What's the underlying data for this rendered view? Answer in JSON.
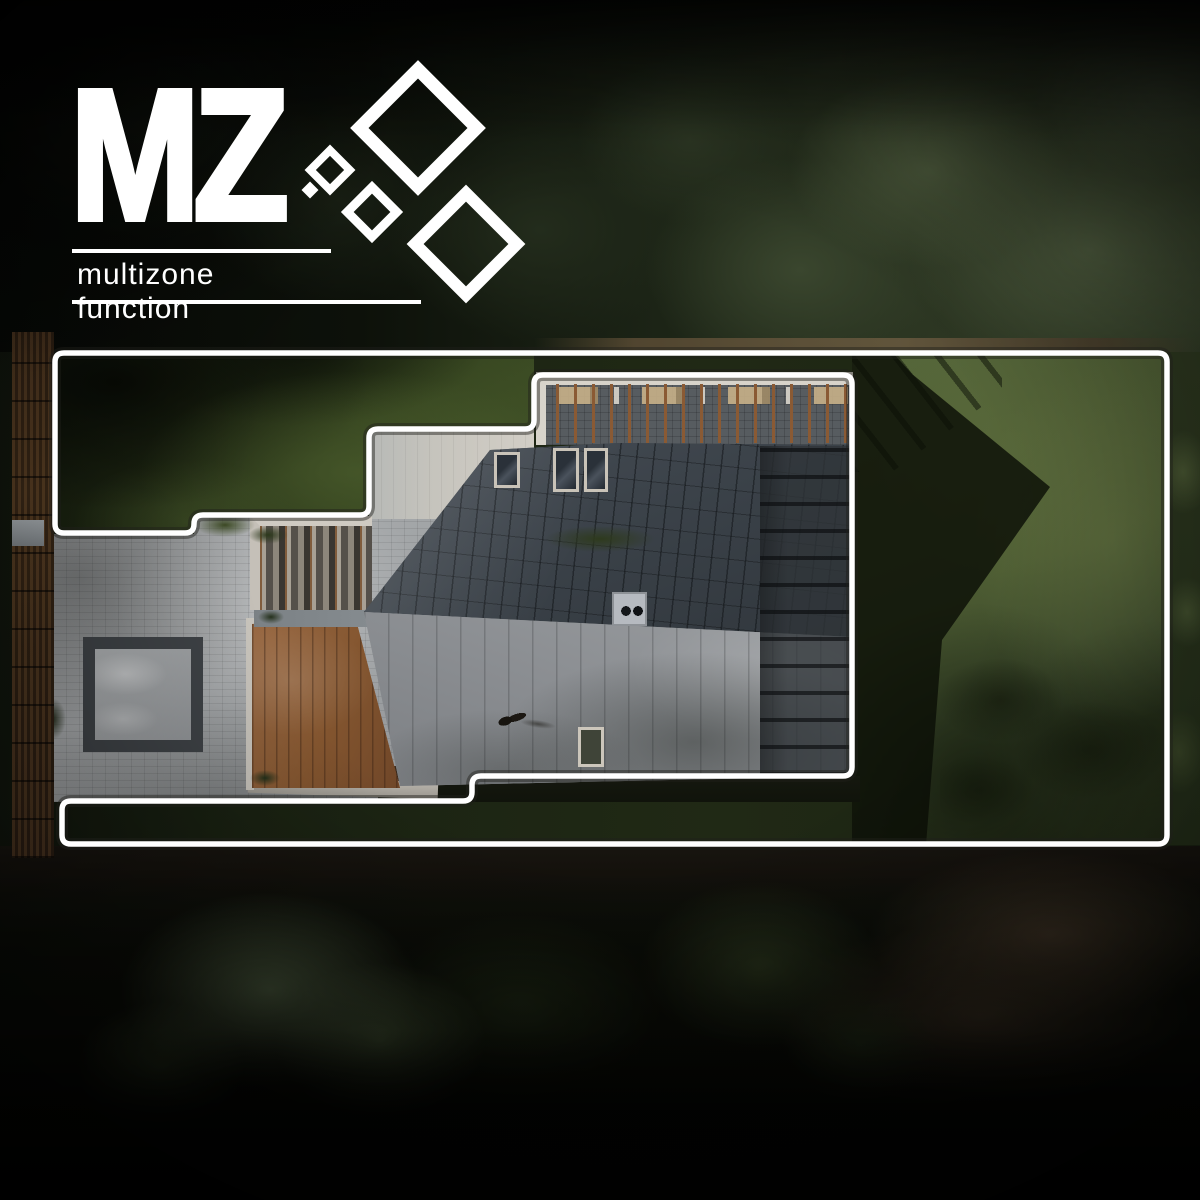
{
  "logo": {
    "title": "MZ",
    "subtitle": "multizone function"
  },
  "zone_outline": {
    "points": "55,353 1167,353 1167,844 62,844 62,801 472,801 472,776 852,776 852,375 534,375 534,429 369,429 369,515 194,515 194,533 55,533",
    "corner_radius": 9,
    "stroke_color": "#ffffff",
    "stroke_width": 5.5,
    "halo_color": "rgba(30,30,26,0.45)",
    "halo_width": 12
  },
  "palette": {
    "logo_white": "#ffffff",
    "lawn_sunlit": "#55663a",
    "lawn_shadow": "#1a2210",
    "roof_dark_tiles": "#3d444b",
    "roof_light_metal": "#8f9296",
    "pavers_gray": "#a9acae",
    "deck_wood": "#8a5a3a",
    "forest_dark": "#0b0d07"
  }
}
